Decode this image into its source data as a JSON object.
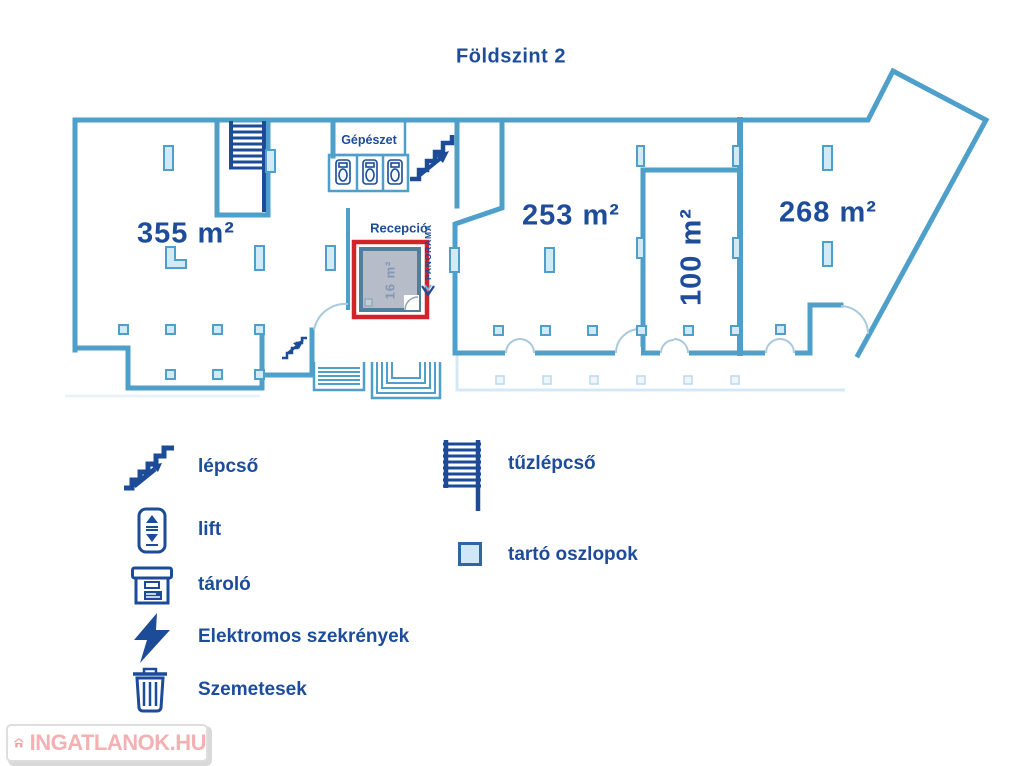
{
  "title": "Földszint 2",
  "colors": {
    "wall_blue": "#4e9fca",
    "label_navy": "#1d4c9a",
    "icon_navy": "#1c4b97",
    "highlight_red": "#d2232a",
    "column_fill": "#d2e9f6",
    "terrace_light": "#d6e8f4",
    "highlight_room_fill": "#b6bdc8",
    "highlight_room_text": "#8397b4",
    "watermark_pink": "#f3b1b3"
  },
  "plan": {
    "rooms": [
      {
        "label": "355 m²"
      },
      {
        "label": "253 m²"
      },
      {
        "label": "100 m²"
      },
      {
        "label": "268 m²"
      }
    ],
    "reception_label": "Recepció",
    "mechanical_label": "Gépészet",
    "highlighted_room": {
      "label": "16 m²"
    },
    "logo_text": "PANORAMA"
  },
  "legend": {
    "left": [
      {
        "icon": "stairs-icon",
        "label": "lépcső"
      },
      {
        "icon": "lift-icon",
        "label": "lift"
      },
      {
        "icon": "storage-icon",
        "label": "tároló"
      },
      {
        "icon": "lightning-icon",
        "label": "Elektromos szekrények"
      },
      {
        "icon": "trash-icon",
        "label": "Szemetesek"
      }
    ],
    "right": [
      {
        "icon": "ladder-icon",
        "label": "tűzlépcső"
      },
      {
        "icon": "column-icon",
        "label": "tartó oszlopok"
      }
    ]
  },
  "watermark": {
    "text": "INGATLANOK.HU"
  }
}
